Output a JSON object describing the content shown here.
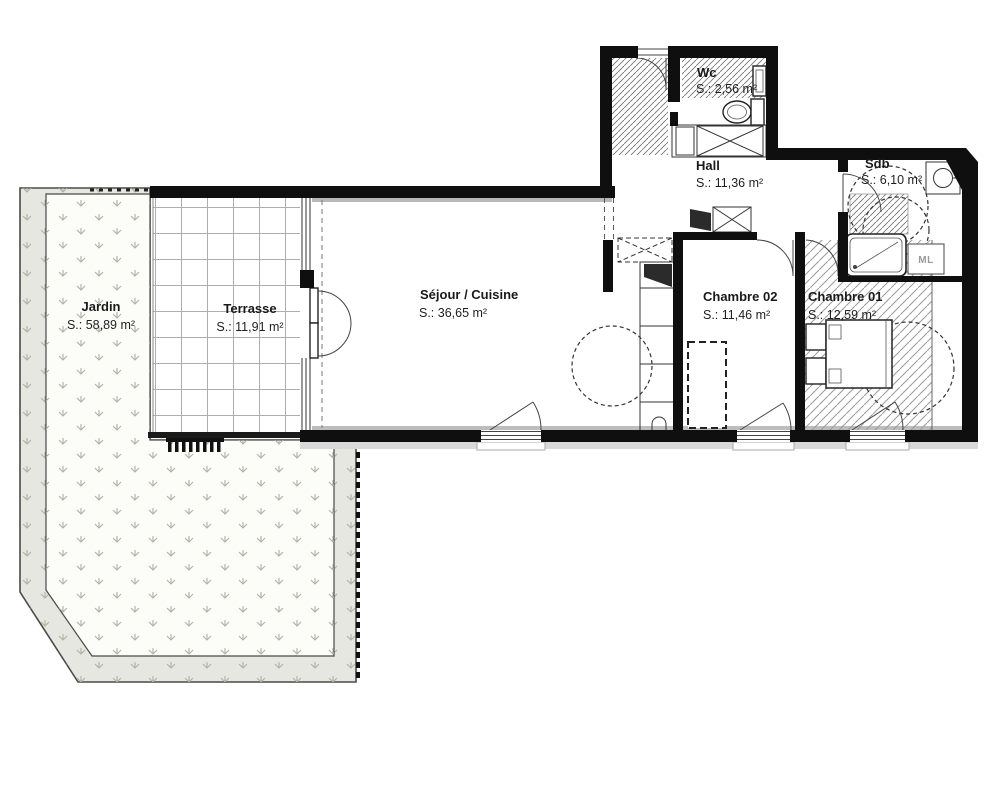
{
  "plan": {
    "rooms": [
      {
        "id": "jardin",
        "name": "Jardin",
        "area": "S.: 58,89 m²"
      },
      {
        "id": "terrasse",
        "name": "Terrasse",
        "area": "S.: 11,91 m²"
      },
      {
        "id": "sejour-cuisine",
        "name": "Séjour / Cuisine",
        "area": "S.: 36,65 m²"
      },
      {
        "id": "wc",
        "name": "Wc",
        "area": "S.: 2,56 m²"
      },
      {
        "id": "hall",
        "name": "Hall",
        "area": "S.: 11,36 m²"
      },
      {
        "id": "sdb",
        "name": "Sdb",
        "area": "S.: 6,10 m²"
      },
      {
        "id": "chambre-02",
        "name": "Chambre 02",
        "area": "S.: 11,46 m²"
      },
      {
        "id": "chambre-01",
        "name": "Chambre 01",
        "area": "S.: 12,59 m²"
      }
    ],
    "fixtures": {
      "washing_machine_label": "ML"
    },
    "colors": {
      "wall": "#0f0f0f",
      "garden_band": "#e7e7e1",
      "garden_inner": "#fcfcf9",
      "grass": "#b0b0a4",
      "hatch": "#8a8a8a",
      "sill": "#d9d9d9"
    }
  }
}
